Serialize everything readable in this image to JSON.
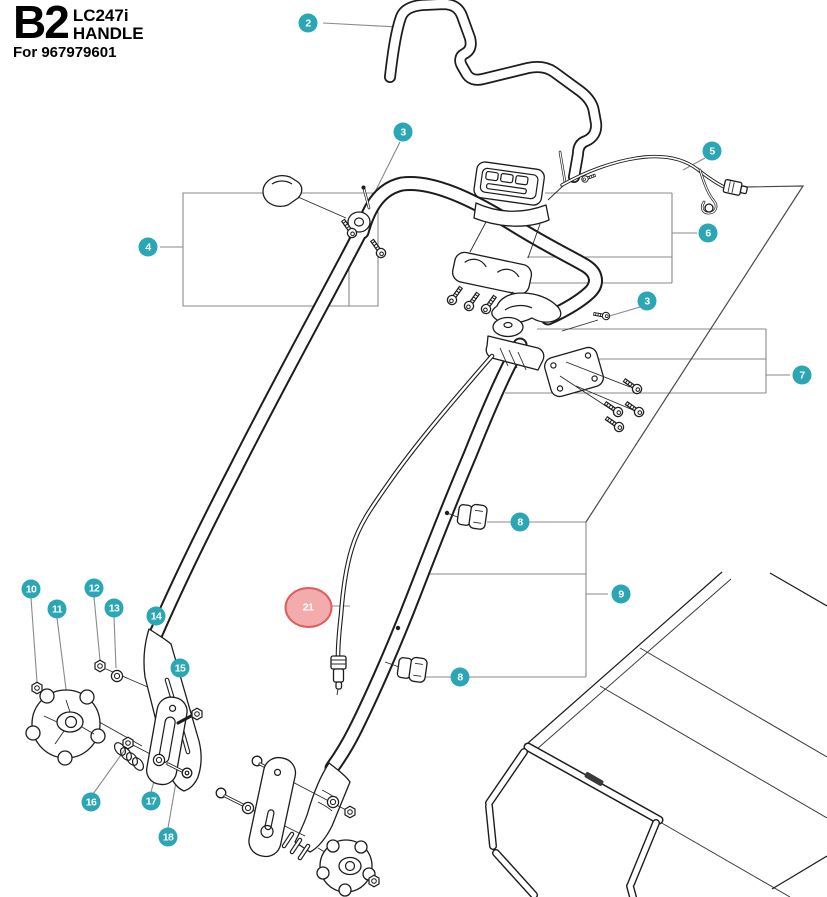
{
  "header": {
    "code": "B2",
    "model": "LC247i",
    "name": "HANDLE",
    "for_label": "For 967979601"
  },
  "colors": {
    "callout_fill": "#2BA6B4",
    "callout_text": "#FFFFFF",
    "highlight_ellipse_fill": "#F4ABAB",
    "highlight_ellipse_border": "#E05B5B",
    "highlight_badge": "#7D6126",
    "artwork_line": "#1C1C1C",
    "leader_line": "#8A8A8A"
  },
  "callouts": [
    {
      "id": "2",
      "number": "2",
      "x": 308,
      "y": 23,
      "highlighted": false
    },
    {
      "id": "3a",
      "number": "3",
      "x": 403,
      "y": 132,
      "highlighted": false
    },
    {
      "id": "4",
      "number": "4",
      "x": 148,
      "y": 247,
      "highlighted": false
    },
    {
      "id": "5",
      "number": "5",
      "x": 712,
      "y": 151,
      "highlighted": false
    },
    {
      "id": "6",
      "number": "6",
      "x": 708,
      "y": 233,
      "highlighted": false
    },
    {
      "id": "3b",
      "number": "3",
      "x": 647,
      "y": 301,
      "highlighted": false
    },
    {
      "id": "7",
      "number": "7",
      "x": 802,
      "y": 375,
      "highlighted": false
    },
    {
      "id": "8a",
      "number": "8",
      "x": 520,
      "y": 522,
      "highlighted": false
    },
    {
      "id": "9",
      "number": "9",
      "x": 621,
      "y": 594,
      "highlighted": false
    },
    {
      "id": "8b",
      "number": "8",
      "x": 460,
      "y": 677,
      "highlighted": false
    },
    {
      "id": "10",
      "number": "10",
      "x": 31,
      "y": 589,
      "highlighted": false
    },
    {
      "id": "11",
      "number": "11",
      "x": 57,
      "y": 609,
      "highlighted": false
    },
    {
      "id": "12",
      "number": "12",
      "x": 94,
      "y": 588,
      "highlighted": false
    },
    {
      "id": "13",
      "number": "13",
      "x": 114,
      "y": 608,
      "highlighted": false
    },
    {
      "id": "14",
      "number": "14",
      "x": 156,
      "y": 616,
      "highlighted": false
    },
    {
      "id": "15",
      "number": "15",
      "x": 180,
      "y": 668,
      "highlighted": false
    },
    {
      "id": "16",
      "number": "16",
      "x": 91,
      "y": 802,
      "highlighted": false
    },
    {
      "id": "17",
      "number": "17",
      "x": 151,
      "y": 801,
      "highlighted": false
    },
    {
      "id": "18",
      "number": "18",
      "x": 168,
      "y": 837,
      "highlighted": false
    },
    {
      "id": "21",
      "number": "21",
      "x": 308,
      "y": 607,
      "highlighted": true
    }
  ]
}
